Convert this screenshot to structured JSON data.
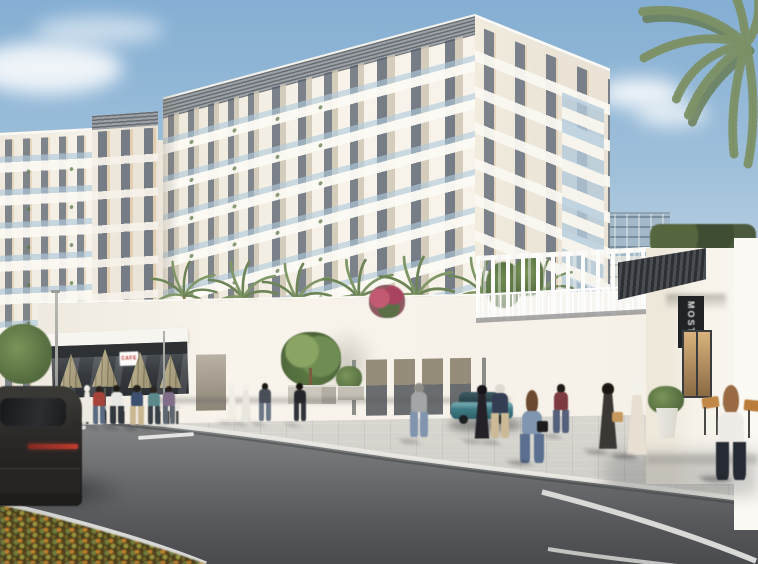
{
  "meta": {
    "type": "architectural-rendering",
    "description": "Street-level render of a white mid-rise residential complex with retail promenade, palm-lined podium terrace, pedestrian bridge, plaza and road with pedestrians in western and Emirati dress"
  },
  "signs": {
    "vertical_storefront_sign": "MOSTE",
    "cafe_sign": "CAFE"
  },
  "palette": {
    "sky_top": "#84aed3",
    "sky_horizon": "#ecefed",
    "facade_sunlit": "#f6f2e9",
    "facade_shade": "#e8e2d6",
    "facade_panel": "#cfc6b4",
    "parapet_louver": "#83888d",
    "glass_railing": "#b7cfe2",
    "window_glass": "#4e5868",
    "window_warm": "#d9b27c",
    "asphalt": "#5f6163",
    "pavement": "#cdccc7",
    "curb": "#e9e8e2",
    "palm_green": "#74875c",
    "hedge_green": "#4b5a3e",
    "umbrella_khaki": "#b5ab8c",
    "canopy_dark": "#33363a",
    "sign_dark": "#202326",
    "cafe_sign_red": "#b8332f",
    "suv_body": "#2e2c2a",
    "car_teal": "#3f7d87",
    "flowerbed_orange": "#bf7f2c",
    "flowerbed_green": "#6e7b3a"
  },
  "scene": {
    "terrace_palm_count": 7,
    "vehicles": [
      {
        "id": "dark-suv-foreground-left"
      },
      {
        "id": "teal-hatchback-parked"
      }
    ],
    "people": [
      {
        "id": "cafe-woman-red",
        "x": 99,
        "y": 426,
        "h": 40,
        "head": "#27201b",
        "top": "#a8433c",
        "bottom": "#5a6b84"
      },
      {
        "id": "cafe-man-white",
        "x": 117,
        "y": 427,
        "h": 42,
        "head": "#1e1a16",
        "top": "#e9e7e3",
        "bottom": "#32373d"
      },
      {
        "id": "cafe-man-navy",
        "x": 137,
        "y": 428,
        "h": 43,
        "head": "#26211c",
        "top": "#3e5070",
        "bottom": "#cab893"
      },
      {
        "id": "cafe-woman-teal",
        "x": 154,
        "y": 427,
        "h": 41,
        "head": "#2c241e",
        "top": "#5b898c",
        "bottom": "#394048"
      },
      {
        "id": "cafe-woman-mauve",
        "x": 169,
        "y": 426,
        "h": 40,
        "head": "#231e19",
        "top": "#806d8a",
        "bottom": "#5d6772"
      },
      {
        "id": "kandura-man-road",
        "x": 87,
        "y": 423,
        "h": 38,
        "head": "#f2efe8",
        "hh": 1.15,
        "robe": "#edeae2"
      },
      {
        "id": "kandura-man-a",
        "x": 232,
        "y": 422,
        "h": 39,
        "head": "#f3f0e9",
        "hh": 1.15,
        "robe": "#f0ede5"
      },
      {
        "id": "kandura-man-b",
        "x": 246,
        "y": 423,
        "h": 40,
        "head": "#f3f0e9",
        "hh": 1.15,
        "robe": "#e9e6de"
      },
      {
        "id": "walker-woman-grey",
        "x": 265,
        "y": 423,
        "h": 40,
        "head": "#1c1813",
        "top": "#4a4e58",
        "bottom": "#6b7687"
      },
      {
        "id": "walker-man-black",
        "x": 300,
        "y": 424,
        "h": 41,
        "head": "#15120e",
        "top": "#24272c",
        "bottom": "#31353a"
      },
      {
        "id": "man-grey-sweater",
        "x": 419,
        "y": 441,
        "h": 58,
        "head": "#8f8c88",
        "top": "#a3a5a7",
        "bottom": "#8195ae"
      },
      {
        "id": "woman-black-abaya",
        "x": 482,
        "y": 441,
        "h": 56,
        "head": "#17141a",
        "robe": "#232027"
      },
      {
        "id": "man-navy-tee-shorts",
        "x": 500,
        "y": 442,
        "h": 58,
        "head": "#ddd8d0",
        "top": "#333d54",
        "bottom": "#ccb996"
      },
      {
        "id": "woman-denim-bag",
        "x": 532,
        "y": 463,
        "h": 73,
        "head": "#6b4930",
        "hh": 2.1,
        "top": "#8095af",
        "bottom": "#5b6f90",
        "bag": "#1c1c1e"
      },
      {
        "id": "man-maroon-top",
        "x": 561,
        "y": 436,
        "h": 52,
        "head": "#1f1b17",
        "top": "#7e3a41",
        "bottom": "#55607a"
      },
      {
        "id": "woman-abaya-tan-bag",
        "x": 608,
        "y": 452,
        "h": 69,
        "head": "#1a1713",
        "robe": "#3b3734",
        "bag": "#c69a5f"
      },
      {
        "id": "man-kandura-tall",
        "x": 637,
        "y": 456,
        "h": 75,
        "head": "#f4f1ea",
        "hh": 1.2,
        "robe": "#e6dfd2"
      },
      {
        "id": "woman-white-top-fg",
        "x": 731,
        "y": 480,
        "h": 95,
        "head": "#9a6b42",
        "hh": 2.0,
        "top": "#efece7",
        "bottom": "#252a33"
      }
    ]
  }
}
